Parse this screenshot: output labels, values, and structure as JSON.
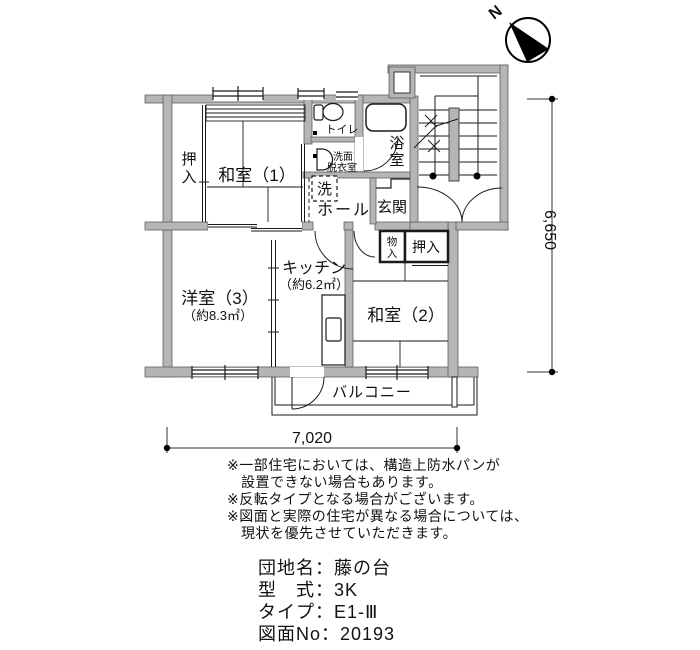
{
  "plan": {
    "compass_n": "N",
    "dim_right": "6,650",
    "dim_bottom": "7,020",
    "labels": {
      "oshiire1": [
        "押",
        "入"
      ],
      "washitsu1": "和室（1）",
      "toilet": "トイレ",
      "senmen": [
        "洗面",
        "脱衣室"
      ],
      "laundry": "洗",
      "hall": "ホール",
      "bath": [
        "浴",
        "室"
      ],
      "genkan": "玄関",
      "monoire": [
        "物",
        "入"
      ],
      "oshiire2": "押入",
      "kitchen": "キッチン",
      "kitchen_area": "（約6.2㎡）",
      "washitsu2": "和室（2）",
      "yoshitsu3": "洋室（3）",
      "yoshitsu3_area": "（約8.3㎡）",
      "balcony": "バルコニー"
    }
  },
  "notes": [
    "※一部住宅においては、構造上防水パンが",
    "設置できない場合もあります。",
    "※反転タイプとなる場合がございます。",
    "※図面と実際の住宅が異なる場合については、",
    "現状を優先させていただきます。"
  ],
  "info": [
    "団地名：藤の台",
    "型　式：3K",
    "タイプ：E1-Ⅲ",
    "図面No：20193"
  ],
  "colors": {
    "wall": "#b5b5b5",
    "line": "#1a1a1a"
  }
}
